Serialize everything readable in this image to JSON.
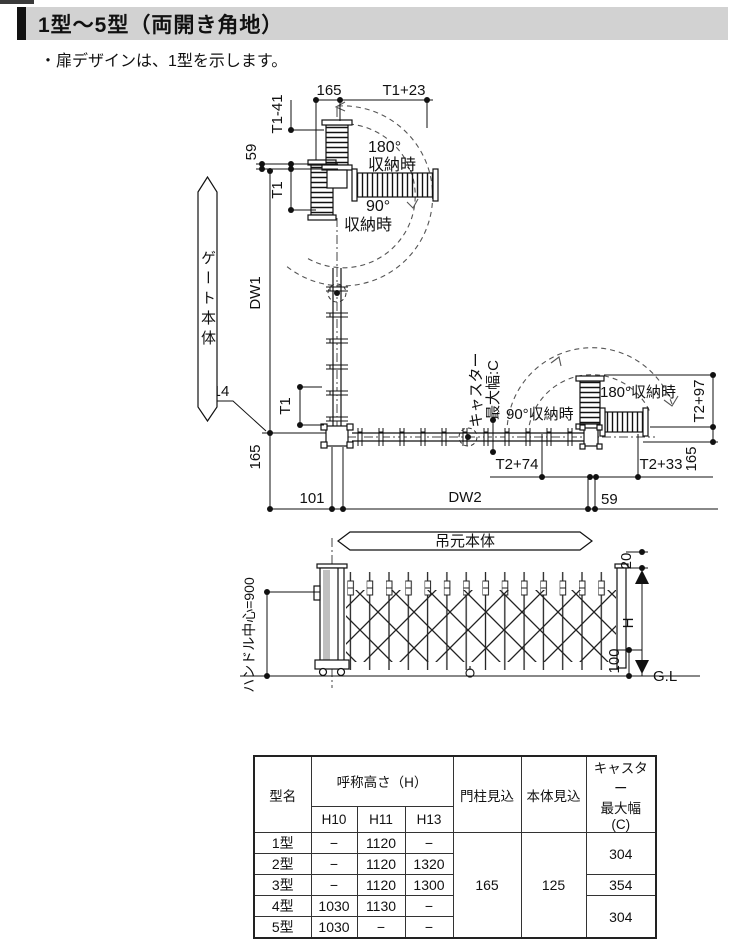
{
  "header": {
    "title": "1型～5型（両開き角地）"
  },
  "note": "・扉デザインは、1型を示します。",
  "diagram": {
    "banners": {
      "gate_body": "ゲート本体",
      "hanging_body": "吊元本体"
    },
    "dims": {
      "d165_top": "165",
      "t1_plus23": "T1+23",
      "t1_minus41": "T1-41",
      "d59_top": "59",
      "t1_upper": "T1",
      "dw1": "DW1",
      "t1_lower": "T1",
      "d14": "14",
      "d165_left": "165",
      "d101": "101",
      "dw2": "DW2",
      "d59_bottom": "59",
      "t2_plus74": "T2+74",
      "t2_plus33": "T2+33",
      "t2_plus97": "T2+97",
      "d165_right": "165"
    },
    "labels": {
      "deg180_top": "180°",
      "stored_top_1": "収納時",
      "deg90_top": "90°",
      "stored_top_2": "収納時",
      "stored90_right": "90°収納時",
      "stored180_right": "180°収納時",
      "caster_line1": "キャスター",
      "caster_line2": "最大幅:C"
    },
    "elevation": {
      "handle_center": "ハンドル中心=900",
      "d20": "20",
      "h": "H",
      "d100": "100",
      "gl": "G.L"
    }
  },
  "table": {
    "headers": {
      "model": "型名",
      "height_group": "呼称高さ（H）",
      "h10": "H10",
      "h11": "H11",
      "h13": "H13",
      "pillar": "門柱見込",
      "body": "本体見込",
      "caster_l1": "キャスター",
      "caster_l2": "最大幅",
      "caster_l3": "(C)"
    },
    "rows": [
      {
        "model": "1型",
        "h10": "−",
        "h11": "1120",
        "h13": "−"
      },
      {
        "model": "2型",
        "h10": "−",
        "h11": "1120",
        "h13": "1320"
      },
      {
        "model": "3型",
        "h10": "−",
        "h11": "1120",
        "h13": "1300"
      },
      {
        "model": "4型",
        "h10": "1030",
        "h11": "1130",
        "h13": "−"
      },
      {
        "model": "5型",
        "h10": "1030",
        "h11": "−",
        "h13": "−"
      }
    ],
    "pillar_value": "165",
    "body_value": "125",
    "caster_values": {
      "rows12": "304",
      "row3": "354",
      "rows45": "304"
    }
  }
}
